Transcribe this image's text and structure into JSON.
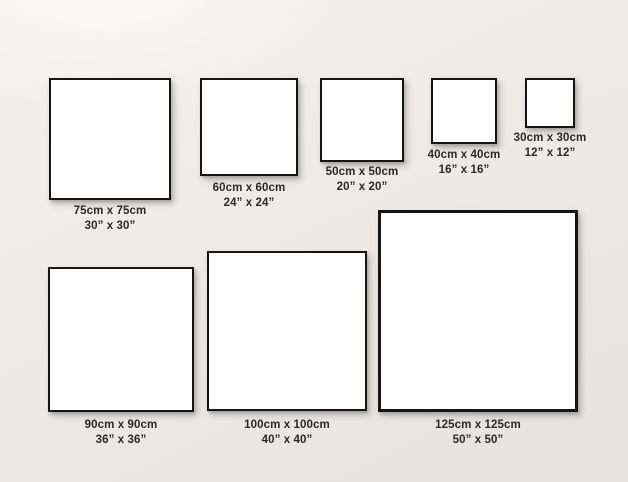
{
  "diagram": {
    "description": "Square canvas / frame size comparison chart",
    "frames": [
      {
        "name": "75cm",
        "cm_label": "75cm x 75cm",
        "inch_label": "30” x 30”"
      },
      {
        "name": "60cm",
        "cm_label": "60cm x 60cm",
        "inch_label": "24” x 24”"
      },
      {
        "name": "50cm",
        "cm_label": "50cm x 50cm",
        "inch_label": "20” x 20”"
      },
      {
        "name": "40cm",
        "cm_label": "40cm x 40cm",
        "inch_label": "16” x 16”"
      },
      {
        "name": "30cm",
        "cm_label": "30cm x 30cm",
        "inch_label": "12” x 12”"
      },
      {
        "name": "90cm",
        "cm_label": "90cm x 90cm",
        "inch_label": "36” x 36”"
      },
      {
        "name": "100cm",
        "cm_label": "100cm x 100cm",
        "inch_label": "40” x 40”"
      },
      {
        "name": "125cm",
        "cm_label": "125cm x 125cm",
        "inch_label": "50” x 50”"
      }
    ],
    "colors": {
      "background": "#ece9e7",
      "frame_border": "#171513",
      "canvas_fill": "#ffffff",
      "label_text": "#2b2a29"
    }
  }
}
